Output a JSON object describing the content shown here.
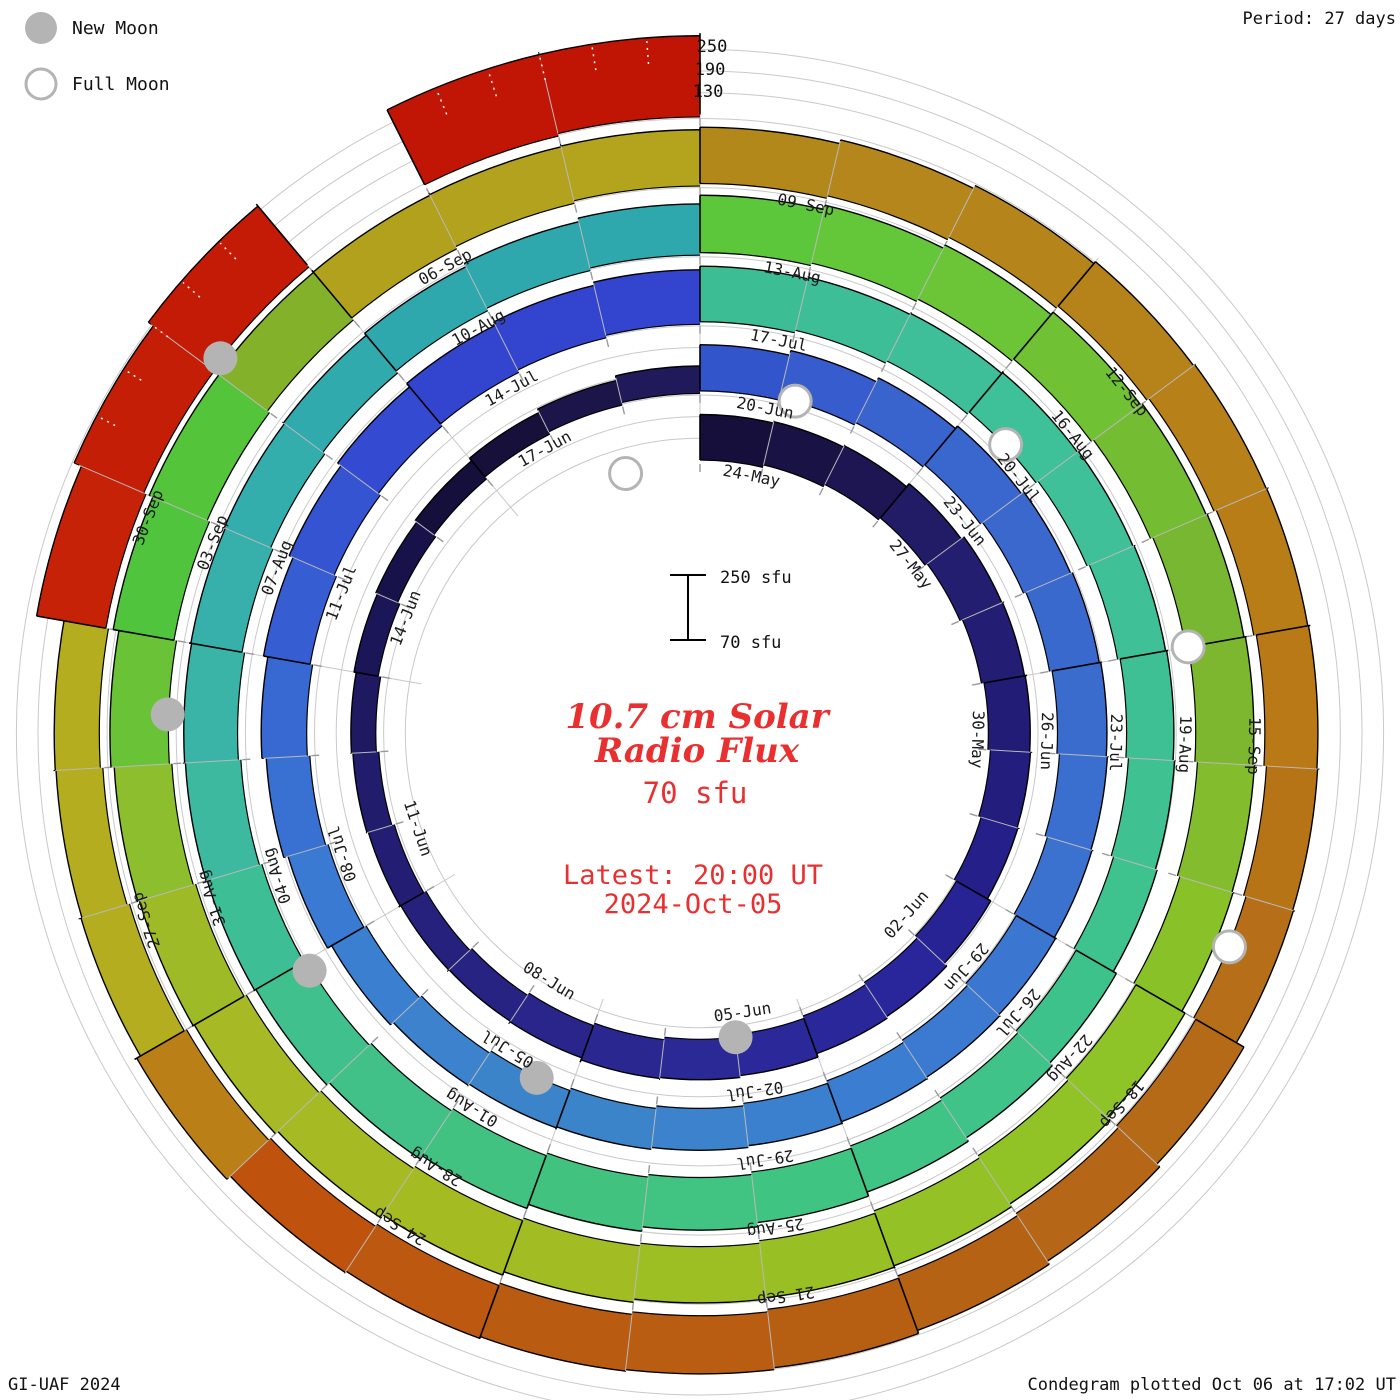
{
  "header": {
    "period_label": "Period: 27 days"
  },
  "legend": {
    "new_moon": "New Moon",
    "full_moon": "Full Moon"
  },
  "footer": {
    "left": "GI-UAF 2024",
    "right": "Condegram plotted Oct 06 at 17:02 UT"
  },
  "center": {
    "title_line1": "10.7 cm Solar",
    "title_line2": "Radio Flux",
    "baseline": "70 sfu",
    "latest_line1": "Latest: 20:00 UT",
    "latest_line2": "2024-Oct-05"
  },
  "scale_bar": {
    "top": "250 sfu",
    "bottom": "70 sfu"
  },
  "radial_axis": {
    "labels": [
      "250",
      "190",
      "130"
    ]
  },
  "chart_data": {
    "type": "bar",
    "subtype": "condegram-spiral-polar-bar",
    "title": "10.7 cm Solar Radio Flux",
    "start_date": "2024-05-24",
    "days_per_revolution": 27,
    "flux_baseline_sfu": 70,
    "radial_ticks_sfu": [
      130,
      190,
      250
    ],
    "date_labels": [
      "24-May",
      "27-May",
      "30-May",
      "02-Jun",
      "05-Jun",
      "08-Jun",
      "11-Jun",
      "14-Jun",
      "17-Jun",
      "20-Jun",
      "23-Jun",
      "26-Jun",
      "29-Jun",
      "02-Jul",
      "05-Jul",
      "08-Jul",
      "11-Jul",
      "14-Jul",
      "17-Jul",
      "20-Jul",
      "23-Jul",
      "26-Jul",
      "29-Jul",
      "01-Aug",
      "04-Aug",
      "07-Aug",
      "10-Aug",
      "13-Aug",
      "16-Aug",
      "19-Aug",
      "22-Aug",
      "25-Aug",
      "28-Aug",
      "31-Aug",
      "03-Sep",
      "06-Sep",
      "09-Sep",
      "12-Sep",
      "15-Sep",
      "18-Sep",
      "21-Sep",
      "24-Sep",
      "27-Sep",
      "30-Sep"
    ],
    "label_step_days": 3,
    "flux_sfu": [
      196,
      193,
      190,
      194,
      196,
      191,
      186,
      181,
      176,
      180,
      183,
      181,
      184,
      182,
      178,
      165,
      156,
      150,
      145,
      142,
      139,
      138,
      136,
      135,
      137,
      140,
      146,
      198,
      204,
      209,
      211,
      212,
      210,
      207,
      203,
      199,
      196,
      193,
      190,
      188,
      186,
      184,
      180,
      177,
      180,
      186,
      191,
      196,
      201,
      206,
      211,
      216,
      219,
      221,
      224,
      221,
      217,
      213,
      209,
      205,
      201,
      198,
      196,
      199,
      202,
      206,
      211,
      216,
      221,
      226,
      229,
      231,
      228,
      224,
      219,
      214,
      210,
      206,
      206,
      209,
      212,
      229,
      235,
      238,
      240,
      238,
      234,
      231,
      228,
      224,
      227,
      230,
      232,
      229,
      226,
      228,
      231,
      234,
      236,
      233,
      230,
      232,
      241,
      245,
      242,
      236,
      231,
      226,
      226,
      229,
      231,
      231,
      228,
      222,
      217,
      212,
      207,
      224,
      228,
      231,
      233,
      231,
      228,
      226,
      223,
      229,
      210,
      200,
      195,
      265,
      280,
      290,
      null,
      302,
      295
    ],
    "color_anchors": [
      [
        0,
        "#140e38"
      ],
      [
        2,
        "#1a1348"
      ],
      [
        4,
        "#241e6e"
      ],
      [
        7,
        "#221c77"
      ],
      [
        10,
        "#28249a"
      ],
      [
        13,
        "#2b2a99"
      ],
      [
        16,
        "#282487"
      ],
      [
        19,
        "#221d70"
      ],
      [
        22,
        "#1a1452"
      ],
      [
        24,
        "#130d33"
      ],
      [
        26.9,
        "#231c60"
      ],
      [
        27,
        "#3152cc"
      ],
      [
        30,
        "#3a66cd"
      ],
      [
        33,
        "#3a6acd"
      ],
      [
        36,
        "#3b74d0"
      ],
      [
        39,
        "#3b7fd0"
      ],
      [
        42,
        "#3c85c8"
      ],
      [
        45,
        "#3b7fd2"
      ],
      [
        48,
        "#3763d2"
      ],
      [
        51,
        "#3345cf"
      ],
      [
        53.9,
        "#3345cf"
      ],
      [
        54,
        "#3cbc92"
      ],
      [
        57,
        "#3ec09a"
      ],
      [
        60,
        "#3fc096"
      ],
      [
        63,
        "#3ec28c"
      ],
      [
        66,
        "#40c483"
      ],
      [
        69,
        "#42c27e"
      ],
      [
        72,
        "#3fc090"
      ],
      [
        75,
        "#38b2ac"
      ],
      [
        78,
        "#2fa8ad"
      ],
      [
        80.9,
        "#2fa8ad"
      ],
      [
        81,
        "#5ac83e"
      ],
      [
        84,
        "#6ec434"
      ],
      [
        87,
        "#7ab430"
      ],
      [
        90,
        "#8cc428"
      ],
      [
        93,
        "#96c126"
      ],
      [
        96,
        "#a4bc22"
      ],
      [
        99,
        "#a8b824"
      ],
      [
        101,
        "#84c030"
      ],
      [
        102,
        "#4fc43e"
      ],
      [
        104,
        "#55c438"
      ],
      [
        105,
        "#b0a01c"
      ],
      [
        107.9,
        "#b5a41d"
      ],
      [
        108,
        "#b2891a"
      ],
      [
        111,
        "#b5831b"
      ],
      [
        114,
        "#b87c16"
      ],
      [
        117,
        "#b56c18"
      ],
      [
        120,
        "#b56014"
      ],
      [
        123,
        "#ba5a10"
      ],
      [
        125,
        "#c0500c"
      ],
      [
        126,
        "#b3ad1f"
      ],
      [
        128.9,
        "#b3ad1f"
      ],
      [
        129,
        "#c62408"
      ],
      [
        131,
        "#c41c06"
      ],
      [
        134,
        "#c01505"
      ]
    ],
    "moons": {
      "new_moon_days": [
        13.0,
        42.4,
        71.9,
        101.4,
        131.1
      ],
      "full_moon_days": [
        -1.2,
        28.2,
        57.5,
        87.0,
        116.4
      ]
    },
    "moon_color": "#b4b4b4",
    "accent_color": "#e93030",
    "grid_color": "#c9c9c9"
  }
}
